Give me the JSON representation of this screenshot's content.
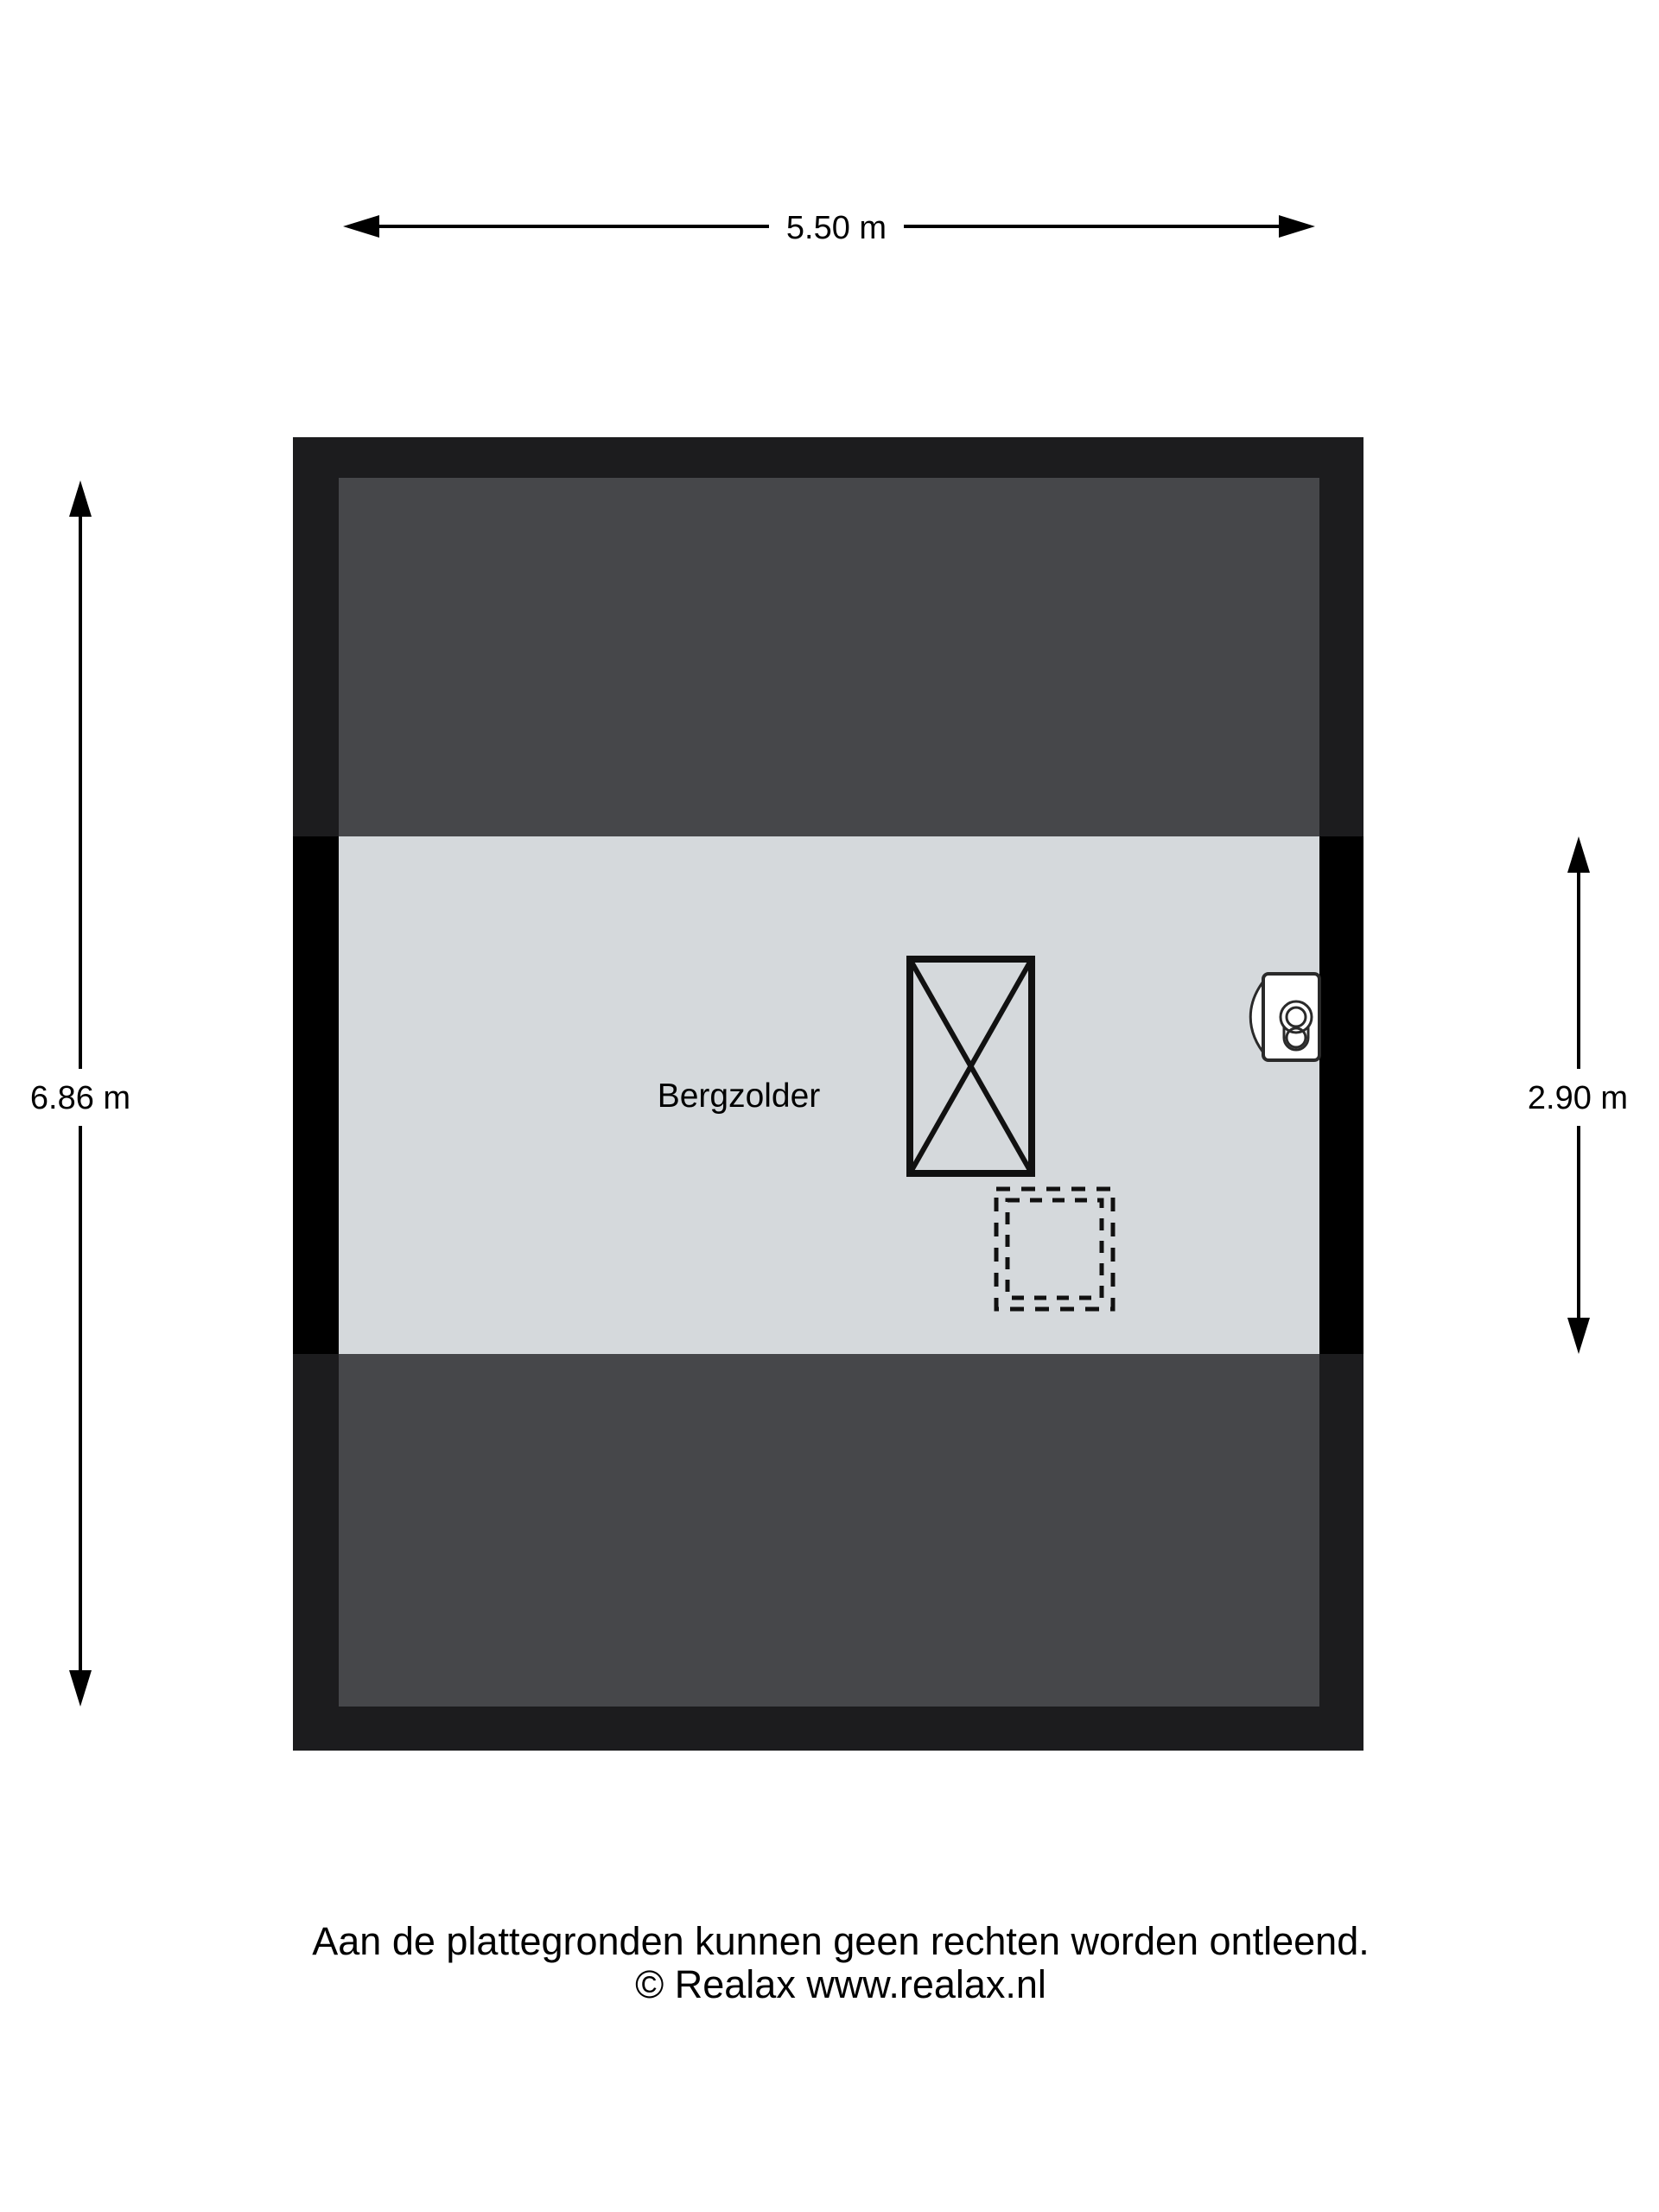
{
  "floorplan": {
    "room": {
      "label": "Bergzolder"
    },
    "dimensions": {
      "total_width": {
        "label": "5.50 m"
      },
      "total_height": {
        "label": "6.86 m"
      },
      "inner_band_height": {
        "label": "2.90 m"
      }
    },
    "colors": {
      "background": "#ffffff",
      "wall_frame": "#1c1c1e",
      "wall_solid_black": "#000000",
      "low_headroom_area": "#46474a",
      "floor_area": "#d5d9dc",
      "dimension_line": "#000000",
      "symbol_stroke": "#2a2a2a",
      "symbol_fill": "#ffffff"
    },
    "symbols": {
      "stair_void": "crossed-rectangle",
      "hatch_opening": "dashed-square",
      "boiler": "wall-mounted-boiler"
    }
  },
  "footer": {
    "disclaimer": "Aan de plattegronden kunnen geen rechten worden ontleend.",
    "copyright": "© Realax www.realax.nl"
  }
}
